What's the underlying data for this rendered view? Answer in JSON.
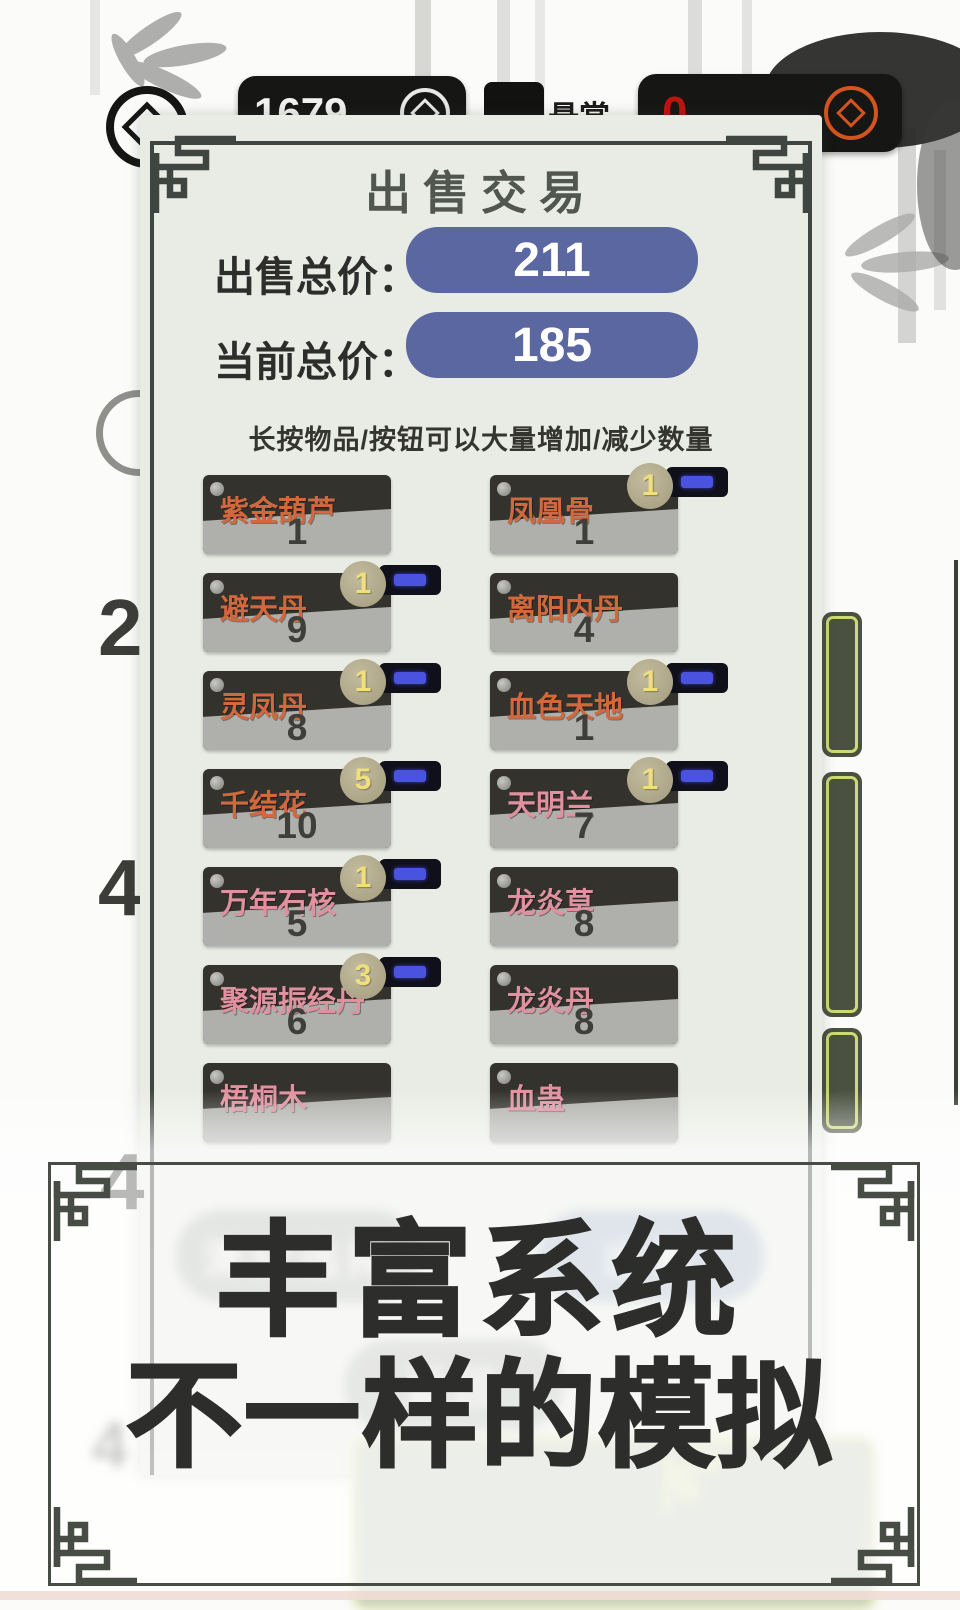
{
  "hud": {
    "coins": "1679",
    "bounty_label": "悬赏",
    "bounty_value": "0"
  },
  "dialog": {
    "title": "出售交易",
    "sell_total_label": "出售总价：",
    "sell_total_value": "211",
    "current_total_label": "当前总价：",
    "current_total_value": "185",
    "hint": "长按物品/按钮可以大量增加/减少数量",
    "items": [
      {
        "name": "紫金葫芦",
        "count": "1",
        "selected": "",
        "color": "orange"
      },
      {
        "name": "凤凰骨",
        "count": "1",
        "selected": "1",
        "color": "orange"
      },
      {
        "name": "避天丹",
        "count": "9",
        "selected": "1",
        "color": "orange"
      },
      {
        "name": "离阳内丹",
        "count": "4",
        "selected": "",
        "color": "orange"
      },
      {
        "name": "灵凤丹",
        "count": "8",
        "selected": "1",
        "color": "orange"
      },
      {
        "name": "血色天地",
        "count": "1",
        "selected": "1",
        "color": "orange"
      },
      {
        "name": "千结花",
        "count": "10",
        "selected": "5",
        "color": "orange"
      },
      {
        "name": "天明兰",
        "count": "7",
        "selected": "1",
        "color": "pink"
      },
      {
        "name": "万年石核",
        "count": "5",
        "selected": "1",
        "color": "pink"
      },
      {
        "name": "龙炎草",
        "count": "8",
        "selected": "",
        "color": "pink"
      },
      {
        "name": "聚源振经丹",
        "count": "6",
        "selected": "3",
        "color": "pink"
      },
      {
        "name": "龙炎丹",
        "count": "8",
        "selected": "",
        "color": "pink"
      },
      {
        "name": "梧桐木",
        "count": "",
        "selected": "",
        "color": "pink"
      },
      {
        "name": "血蛊",
        "count": "",
        "selected": "",
        "color": "pink"
      }
    ],
    "buttons": {
      "clear": "清空选择",
      "sell": "出售",
      "back": "返回"
    }
  },
  "background": {
    "numbers": [
      "2",
      "4",
      "4"
    ],
    "faint_number": "4"
  },
  "overlay": {
    "slogan_line1": "丰富系统",
    "slogan_line2": "不一样的模拟"
  },
  "colors": {
    "panel_bg": "#e9ece4",
    "frame_dark": "#3f4540",
    "price_pill_blue": "#5a67a0",
    "item_name_orange": "#d2693e",
    "item_name_pink": "#e0919f",
    "badge_bg": "#b2aa8c",
    "badge_text": "#f0df7c",
    "minus_bar": "#4a52e0",
    "bounty_red": "#c01210",
    "coin_orange": "#d4541e"
  }
}
